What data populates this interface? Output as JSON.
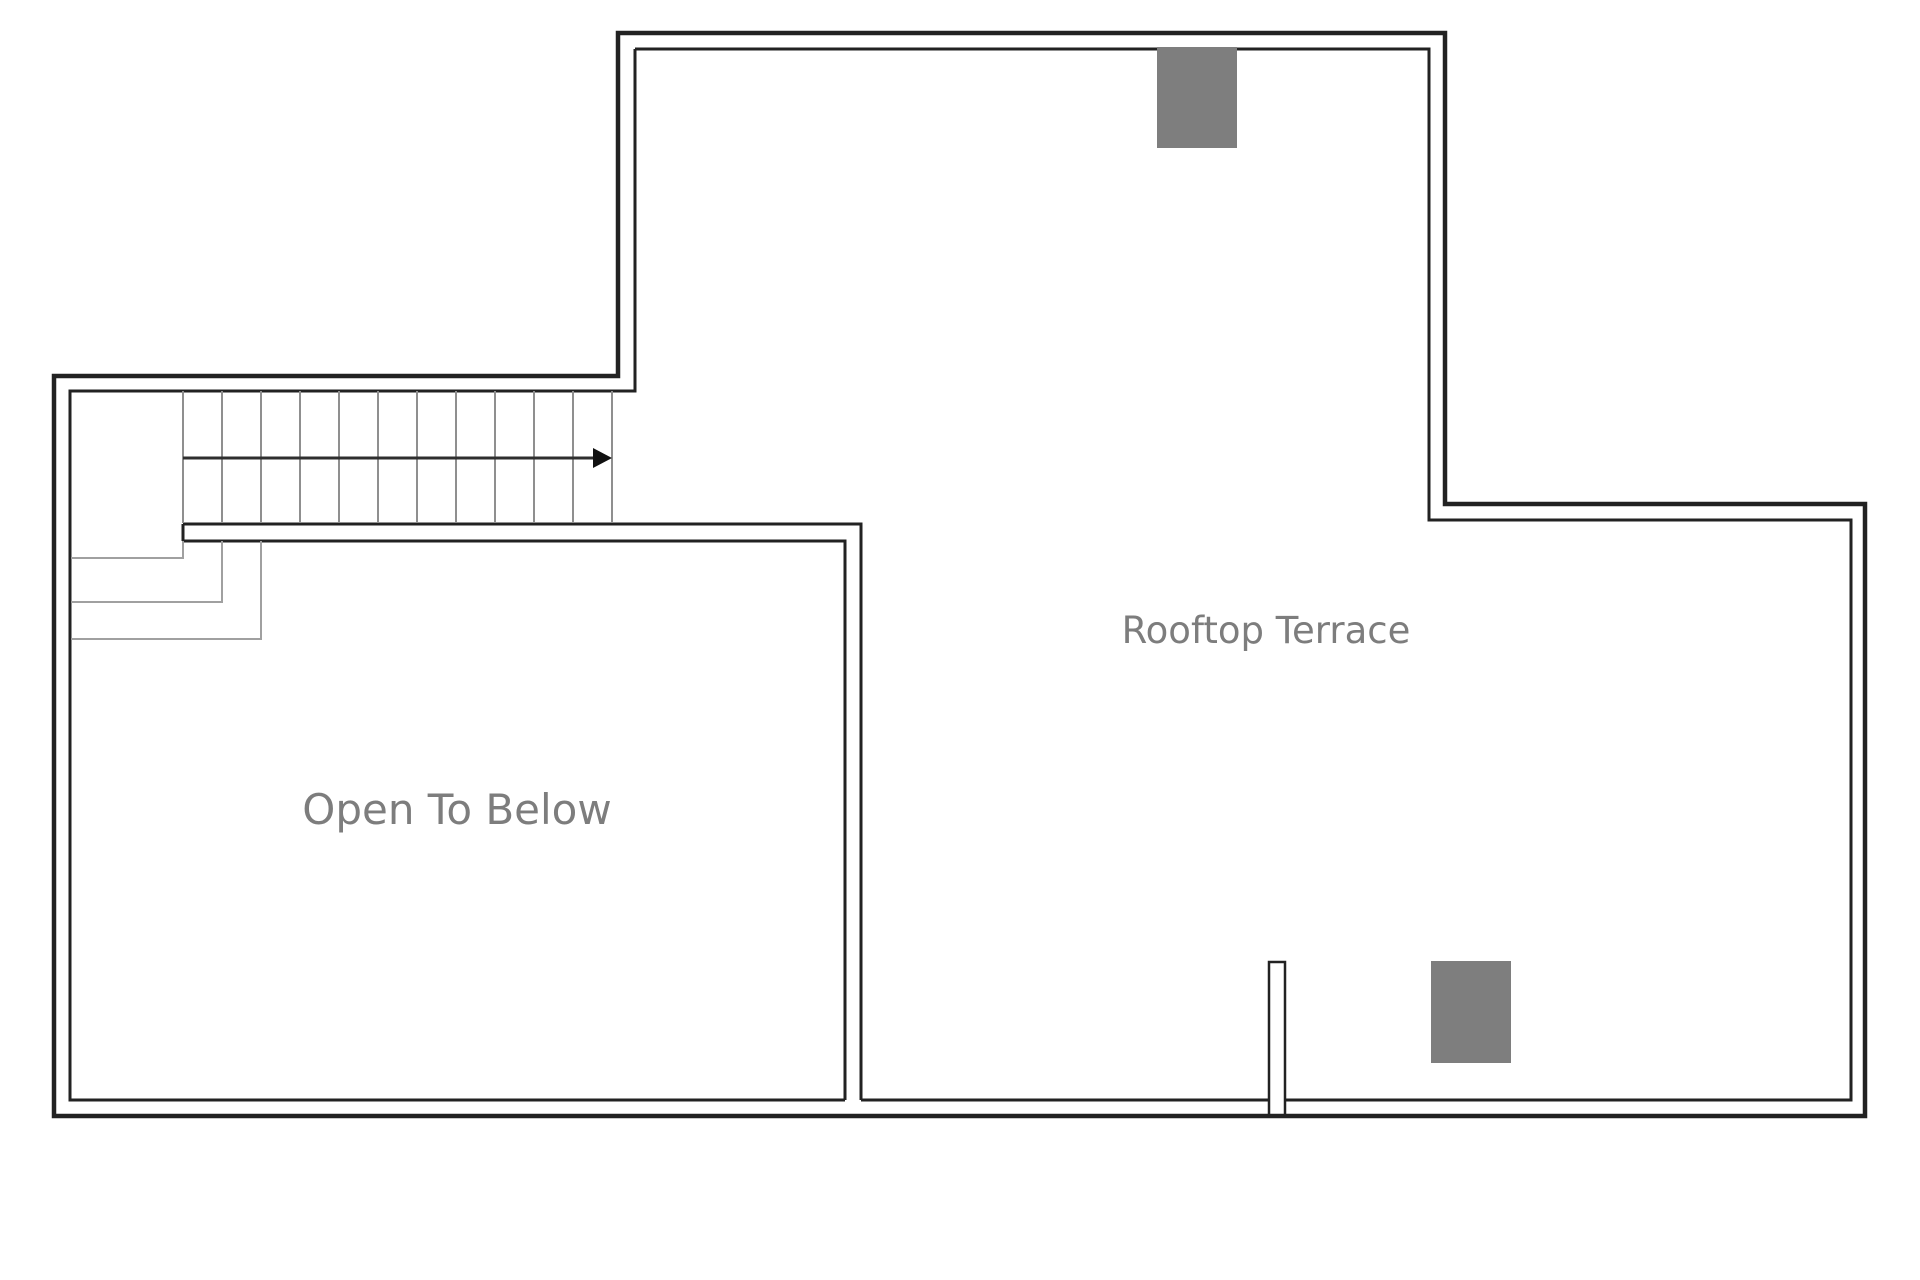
{
  "plan": {
    "rooms": [
      {
        "label": "Rooftop Terrace"
      },
      {
        "label": "Open To Below"
      }
    ],
    "stairs": {
      "tread_count": 12,
      "direction": "right",
      "winder_count": 3
    },
    "fixtures": {
      "count": 2,
      "type": "roof-fixture-block"
    },
    "colors": {
      "wall": "#222222",
      "tread": "#8f8f8f",
      "winder": "#a0a0a0",
      "arrow": "#2f2f2f",
      "fixture": "#7e7e7e",
      "label": "#7d7d7d",
      "bg": "#ffffff"
    }
  }
}
